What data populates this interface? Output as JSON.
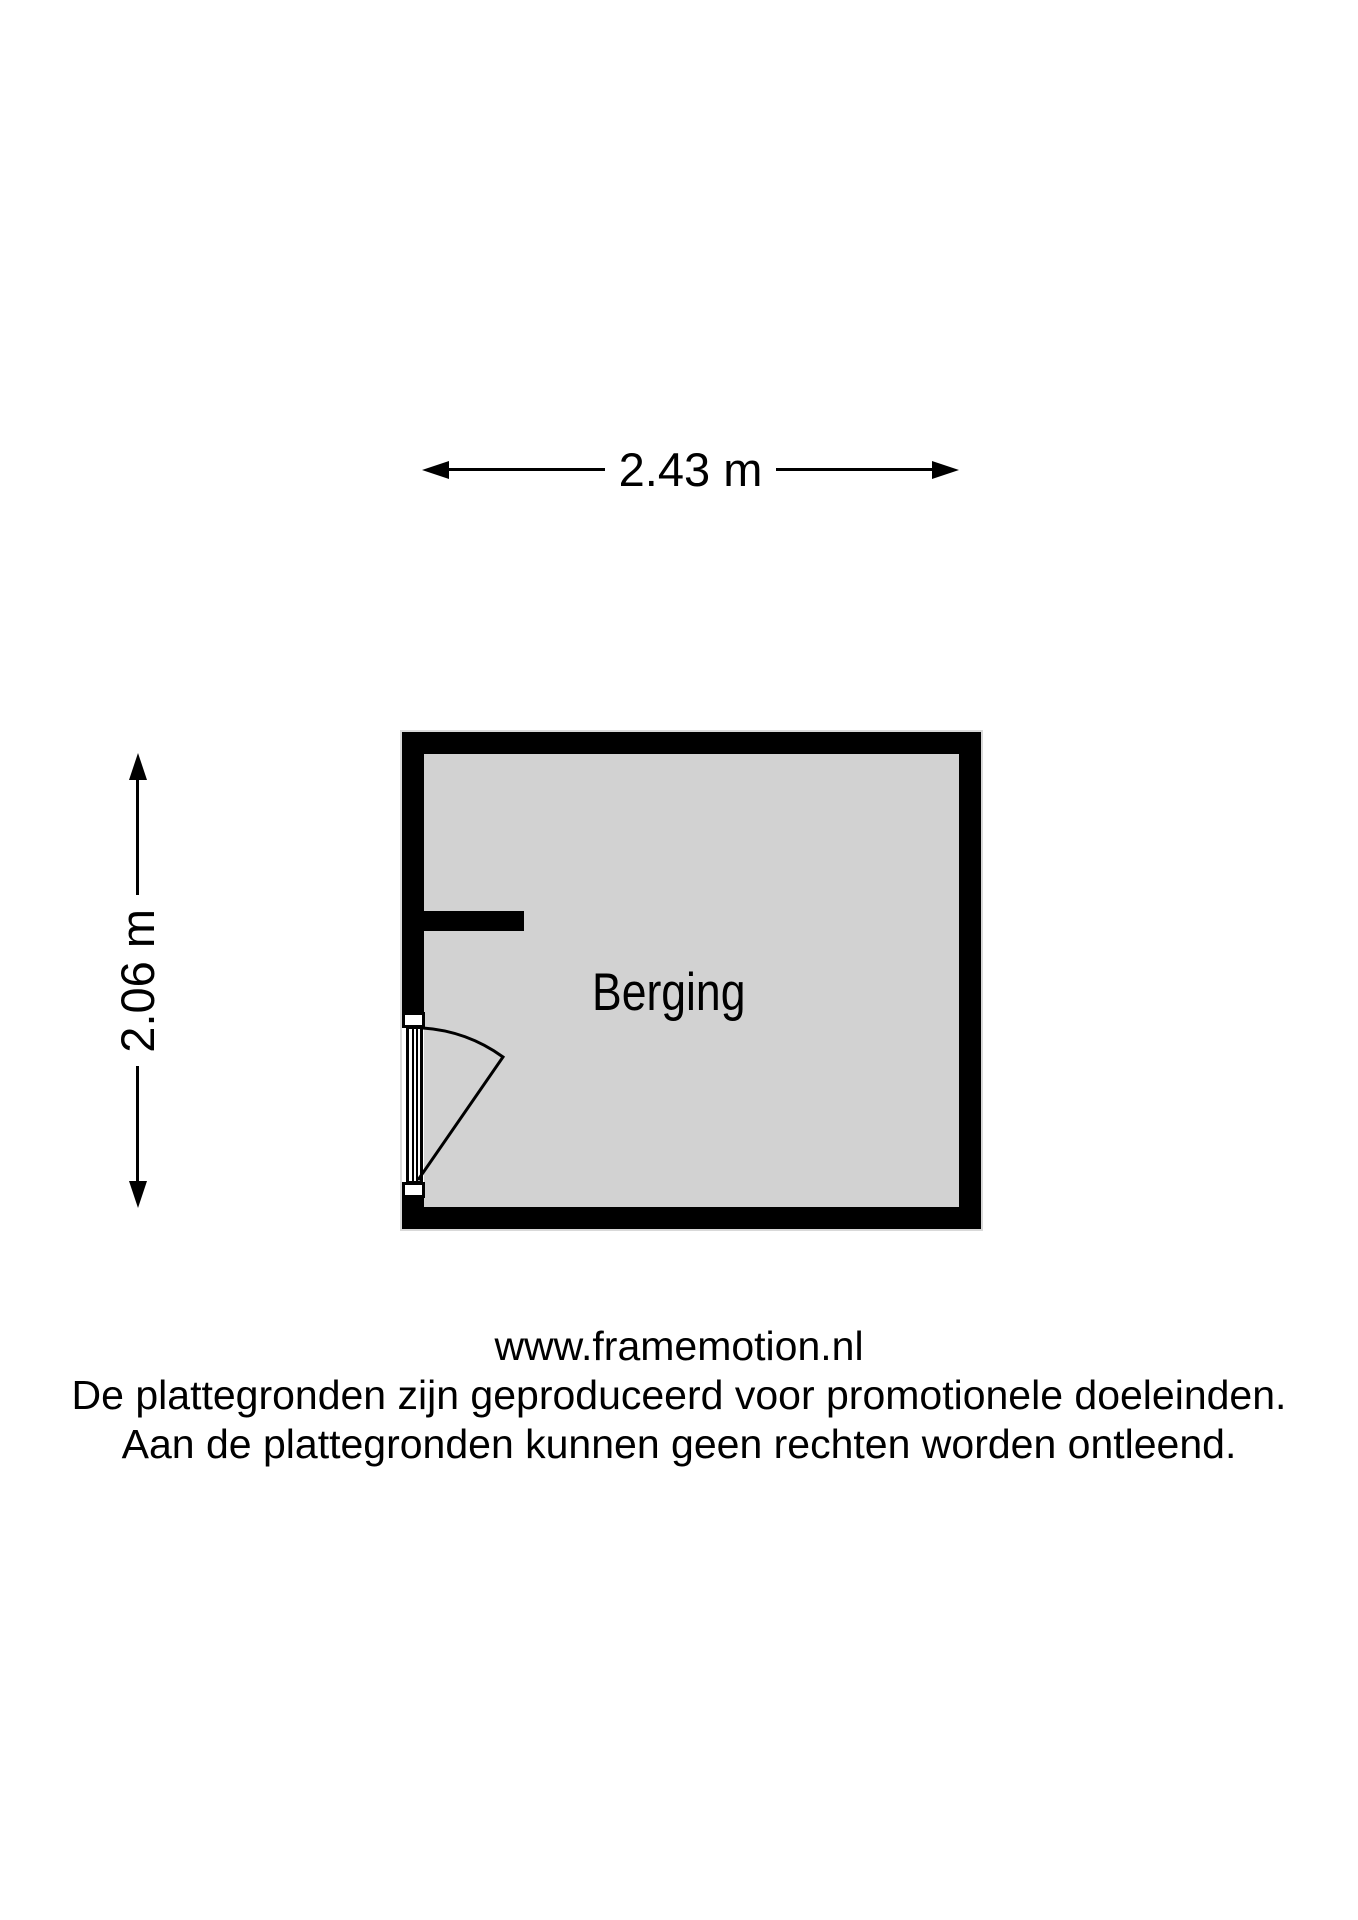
{
  "floorplan": {
    "room_label": "Berging",
    "width_label": "2.43 m",
    "height_label": "2.06 m"
  },
  "footer": {
    "website": "www.framemotion.nl",
    "disclaimer_line1": "De plattegronden zijn geproduceerd voor promotionele doeleinden.",
    "disclaimer_line2": "Aan de plattegronden kunnen geen rechten worden ontleend."
  },
  "colors": {
    "wall": "#000000",
    "floor": "#d2d2d2",
    "background": "#ffffff",
    "text": "#000000"
  }
}
